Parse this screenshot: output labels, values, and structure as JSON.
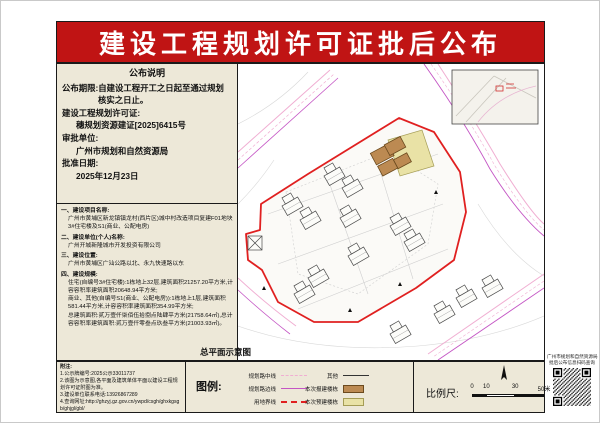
{
  "banner": {
    "title": "建设工程规划许可证批后公布",
    "bg_color": "#c01414",
    "text_color": "#ffffff"
  },
  "notice": {
    "title": "公布说明",
    "lines": [
      "公布期限:自建设工程开工之日起至通过规划",
      "核实之日止。",
      "建设工程规划许可证:",
      "穗规划资源建证[2025]6415号",
      "审批单位:",
      "广州市规划和自然资源局",
      "批准日期:",
      "2025年12月23日"
    ]
  },
  "project": {
    "items": [
      {
        "label": "一、建设项目名称:",
        "body": "广州市黄埔区新龙镇镇龙村(西片区)城中村改造项目复建F01地块3#住宅楼及S1(商业、公配电房)"
      },
      {
        "label": "二、建设单位(个人)名称:",
        "body": "广州开城新隆城市开发投资有限公司"
      },
      {
        "label": "三、建设位置:",
        "body": "广州市黄埔区广汕公路以北、永九快速路以东"
      },
      {
        "label": "四、建设规模:",
        "body1": "住宅(自编号3#住宅楼):1栋地上32层,建筑面积21257.20平方米,计容容积率建筑面积20648.94平方米;",
        "body2": "商业、其他(自编号S1(商业、公配电房)):1栋地上1层,建筑面积581.44平方米,计容容积率建筑面积354.99平方米;",
        "body3": "总建筑面积:贰万壹仟柒佰伍拾捌点陆肆平方米(21758.64㎡),总计容容积率建筑面积:贰万壹仟零叁点玖叁平方米(21003.93㎡)。"
      }
    ]
  },
  "notes": {
    "title": "附注:",
    "lines": [
      "1.公示牌编号:2025公示33011737",
      "2.该图为示意图,各平面及建筑单体平面以建设工程规划许可证附图为准。",
      "3.建设单位联系电话:13926867289",
      "4.查询网址:http://ghzyj.gz.gov.cn/ywpd/csgh/ghxkgsgb/ghjgl/gbl/"
    ]
  },
  "legend": {
    "title": "图例:",
    "line_items": [
      {
        "label": "规划路中线",
        "style": "dashed",
        "color": "#f0aed2"
      },
      {
        "label": "规划路边线",
        "style": "solid",
        "color": "#c455c4"
      },
      {
        "label": "用地界线",
        "style": "dashed-bold",
        "color": "#e02020"
      },
      {
        "label": "其他",
        "style": "solid",
        "color": "#333333"
      }
    ],
    "fill_items": [
      {
        "label": "本次报建楼栋",
        "color": "#bc8a52"
      },
      {
        "label": "本次预建楼栋",
        "color": "#e9e2a6"
      }
    ]
  },
  "scale": {
    "label": "比例尺:",
    "ticks": [
      "0",
      "10",
      "30",
      "50米"
    ]
  },
  "map": {
    "caption": "总平面示意图"
  },
  "qr": {
    "line1": "广州市规划和自然资源局",
    "line2": "批后公布信息扫码查询"
  },
  "colors": {
    "banner_red": "#c01414",
    "paper_beige": "#ede8d8",
    "boundary_red": "#e02020",
    "road_pink": "#f0aed2",
    "road_magenta": "#c455c4",
    "approved_building_brown": "#bc8a52",
    "planned_building_yellow": "#e9e2a6"
  }
}
